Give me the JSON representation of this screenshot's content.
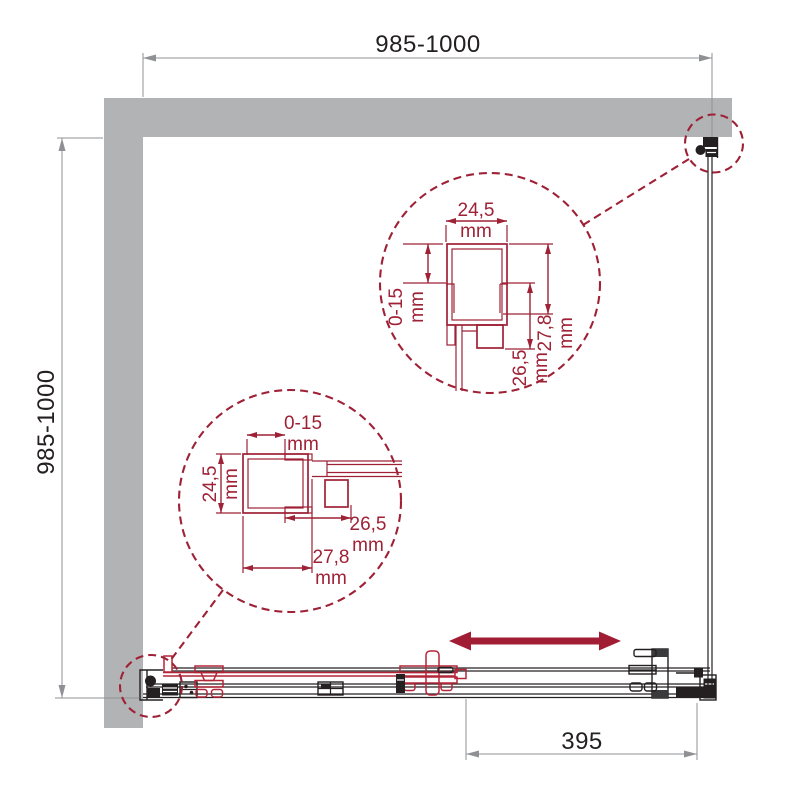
{
  "drawing": {
    "outer_dimensions": {
      "top": "985-1000",
      "left": "985-1000",
      "bottom_door_travel": "395"
    },
    "upper_detail": {
      "width": {
        "value": "24,5",
        "unit": "mm"
      },
      "adjustment": {
        "value": "0-15",
        "unit": "mm"
      },
      "depth_total": {
        "value": "27,8",
        "unit": "mm"
      },
      "depth_inner": {
        "value": "26,5",
        "unit": "mm"
      }
    },
    "lower_detail": {
      "adjustment": {
        "value": "0-15",
        "unit": "mm"
      },
      "width": {
        "value": "24,5",
        "unit": "mm"
      },
      "depth_inner": {
        "value": "26,5",
        "unit": "mm"
      },
      "depth_total": {
        "value": "27,8",
        "unit": "mm"
      }
    },
    "colors": {
      "wall_gray": "#b2b3b5",
      "detail_maroon": "#9e2136",
      "hardware_red": "#b32638",
      "line_black": "#242021",
      "dim_gray": "#8f9093",
      "arrow_red": "#a01d33"
    }
  }
}
